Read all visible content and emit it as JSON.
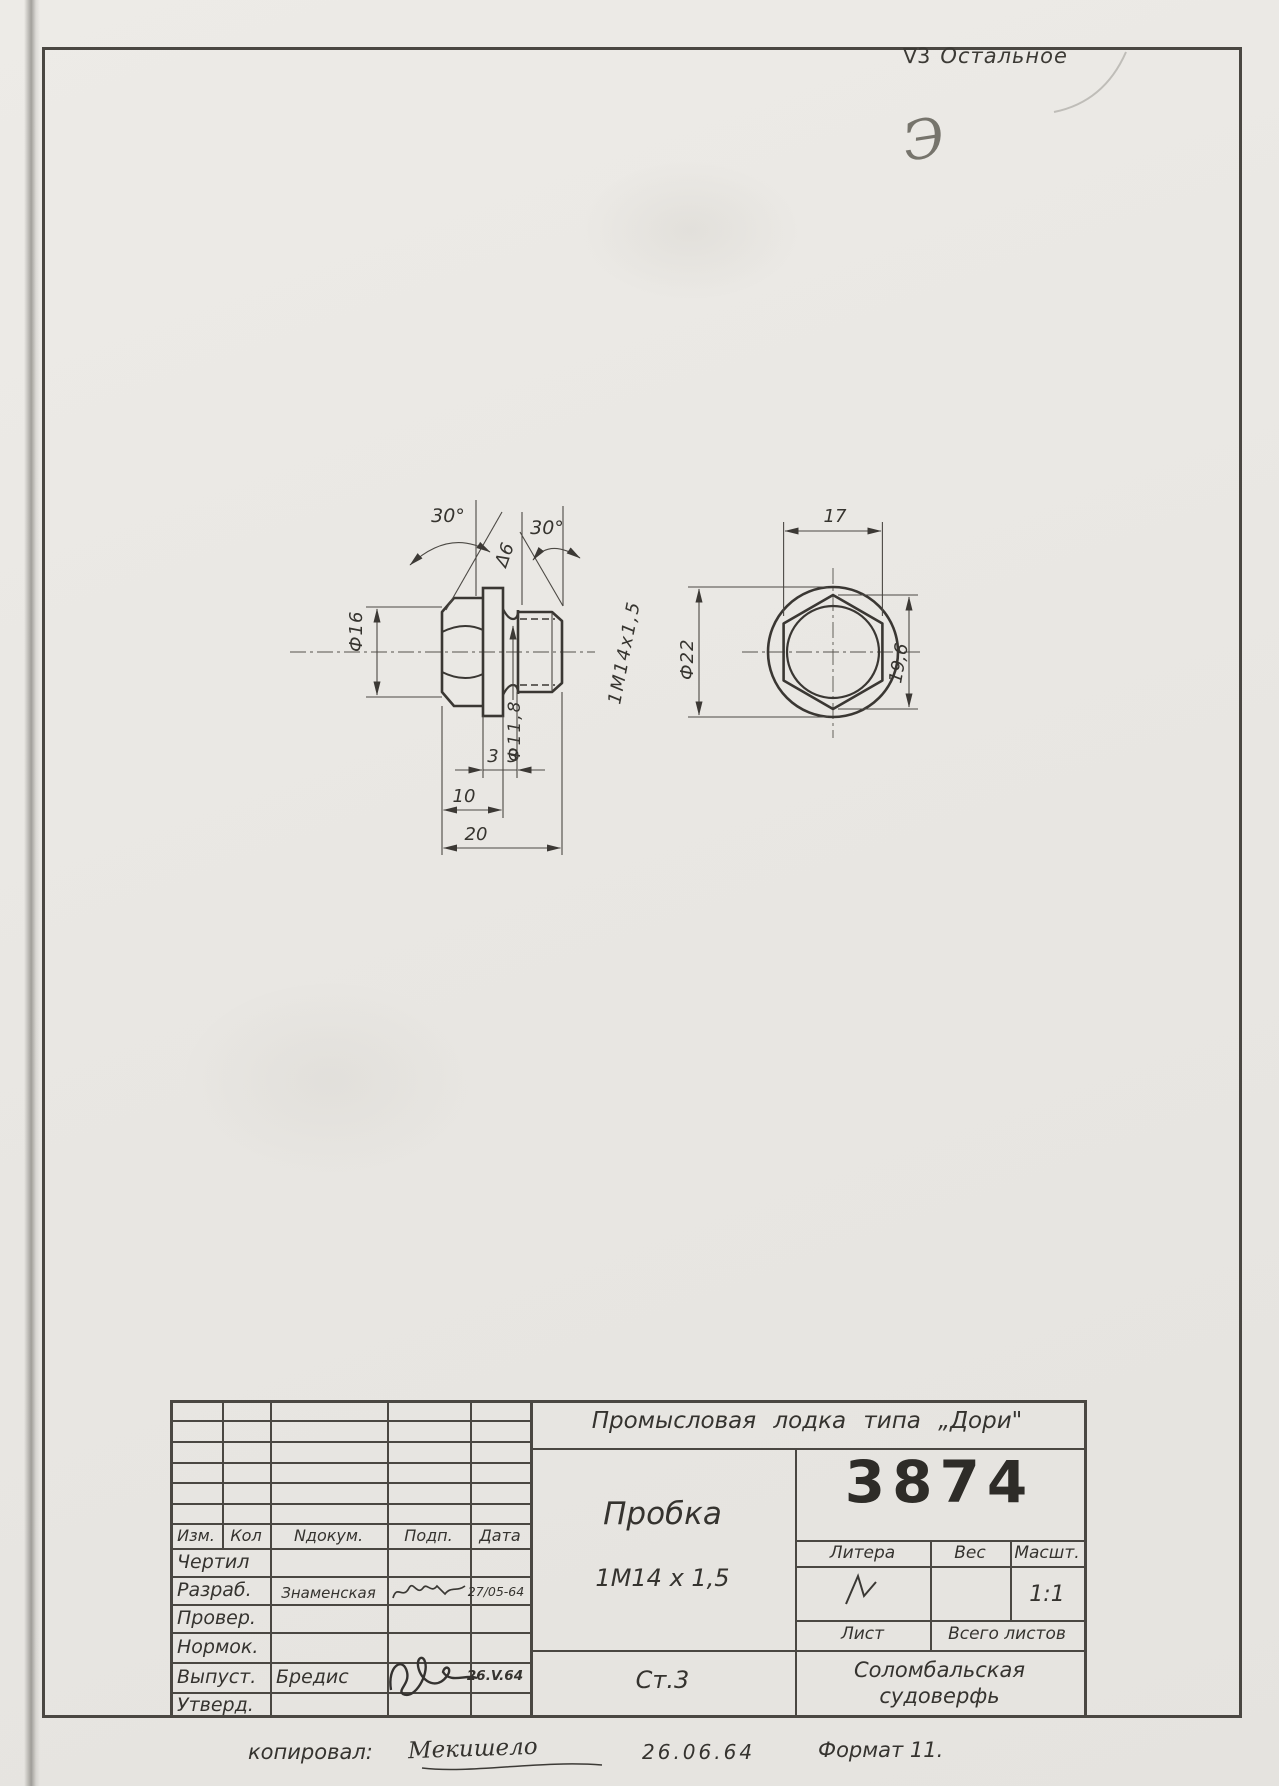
{
  "annotations": {
    "surface_note_symbol": "∇3",
    "surface_note_text": "Остальное",
    "corner_mark": "Э"
  },
  "drawing": {
    "side_view": {
      "angle_left": "30°",
      "finish_mark": "Δ6",
      "angle_right": "30°",
      "head_diameter": "Ф16",
      "groove_diameter": "Ф11,8",
      "thread": "1М14х1,5",
      "collar_width": "3",
      "groove_width": "3",
      "head_length": "10",
      "overall_length": "20"
    },
    "end_view": {
      "across_flats": "17",
      "collar_diameter": "Ф22",
      "across_corners": "19,6"
    }
  },
  "title_block": {
    "project": "Промысловая  лодка  типа „Дори\"",
    "part_name": "Пробка",
    "part_spec": "1М14 х 1,5",
    "material": "Ст.3",
    "drawing_number": "3874",
    "litera_label": "Литера",
    "weight_label": "Вес",
    "scale_label": "Масшт.",
    "scale_value": "1:1",
    "sheet_label": "Лист",
    "total_sheets_label": "Всего  листов",
    "factory_line1": "Соломбальская",
    "factory_line2": "судоверфь",
    "revision_header": {
      "izm": "Изм.",
      "kol": "Кол",
      "ndokum": "Nдокум.",
      "podp": "Подп.",
      "data": "Дата"
    },
    "rows": [
      {
        "role": "Чертил",
        "name": "",
        "date": ""
      },
      {
        "role": "Разраб.",
        "name": "Знаменская",
        "date": "27/05-64"
      },
      {
        "role": "Провер.",
        "name": "",
        "date": ""
      },
      {
        "role": "Нормок.",
        "name": "",
        "date": ""
      },
      {
        "role": "Выпуст.",
        "name": "Бредис",
        "date": "26.V.64"
      },
      {
        "role": "Утверд.",
        "name": "",
        "date": ""
      }
    ]
  },
  "footer": {
    "copied_label": "копировал:",
    "copied_name": "Мекишело",
    "date": "26.06.64",
    "format_note": "Формат 11."
  }
}
